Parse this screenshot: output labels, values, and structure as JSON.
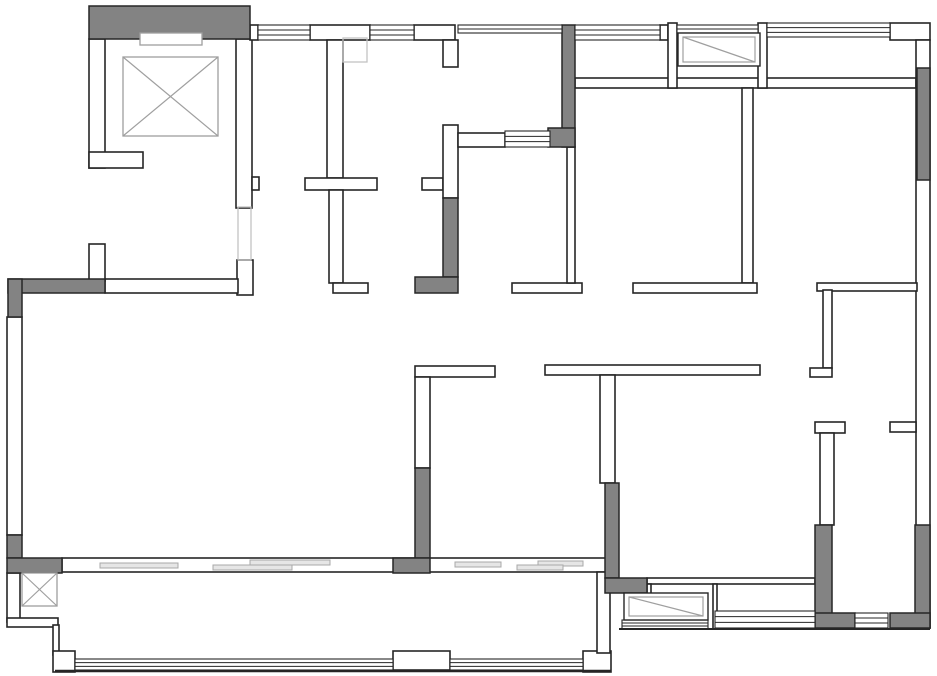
{
  "canvas": {
    "width": 937,
    "height": 676,
    "background": "#ffffff"
  },
  "palette": {
    "wall_stroke": "#262626",
    "wall_fill": "#ffffff",
    "column_fill": "#838383",
    "light_stroke": "#9f9f9f",
    "faint_stroke": "#c2c2c2",
    "panel_fill": "#e6e6e6",
    "panel_stroke": "#a8a8a8"
  },
  "shapes": [
    {
      "t": "wall",
      "n": "elevator-wall-left",
      "b": [
        89,
        39,
        16,
        129
      ]
    },
    {
      "t": "wall",
      "n": "elevator-wall-foot-left",
      "b": [
        89,
        152,
        54,
        16
      ]
    },
    {
      "t": "wall",
      "n": "elevator-wall-right",
      "b": [
        236,
        39,
        16,
        169
      ]
    },
    {
      "t": "wall",
      "n": "hall-wall-bump",
      "b": [
        252,
        177,
        7,
        13
      ]
    },
    {
      "t": "wall",
      "n": "hall-wall-lower",
      "b": [
        237,
        260,
        16,
        35
      ]
    },
    {
      "t": "wall",
      "n": "hall-wall-horizontal",
      "b": [
        105,
        279,
        133,
        14
      ]
    },
    {
      "t": "wall",
      "n": "wall-stub-left",
      "b": [
        89,
        244,
        16,
        37
      ]
    },
    {
      "t": "wall",
      "n": "exterior-wall-left",
      "b": [
        7,
        317,
        15,
        218
      ]
    },
    {
      "t": "wall",
      "n": "top-pier-a",
      "b": [
        250,
        25,
        8,
        15
      ]
    },
    {
      "t": "wall",
      "n": "top-pier-b",
      "b": [
        310,
        25,
        60,
        15
      ]
    },
    {
      "t": "wall",
      "n": "top-pier-c",
      "b": [
        414,
        25,
        41,
        15
      ]
    },
    {
      "t": "wall",
      "n": "top-pier-d",
      "b": [
        660,
        25,
        8,
        15
      ]
    },
    {
      "t": "wall",
      "n": "bath-stub-top",
      "b": [
        443,
        40,
        15,
        27
      ]
    },
    {
      "t": "wall",
      "n": "entry-wall-vertical-upper",
      "b": [
        327,
        40,
        16,
        138
      ]
    },
    {
      "t": "wall",
      "n": "entry-wall-cross",
      "b": [
        305,
        178,
        72,
        12
      ]
    },
    {
      "t": "wall",
      "n": "entry-wall-vertical-lower",
      "b": [
        329,
        190,
        14,
        93
      ]
    },
    {
      "t": "wall",
      "n": "entry-wall-foot",
      "b": [
        333,
        283,
        35,
        10
      ]
    },
    {
      "t": "wall",
      "n": "kitchen-stub",
      "b": [
        422,
        178,
        21,
        12
      ]
    },
    {
      "t": "wall",
      "n": "bath-wall-left",
      "b": [
        443,
        125,
        15,
        73
      ]
    },
    {
      "t": "wall",
      "n": "bath-wall-horizontal",
      "b": [
        458,
        133,
        47,
        14
      ]
    },
    {
      "t": "wall",
      "n": "hallway-wall-horizontal",
      "b": [
        512,
        283,
        70,
        10
      ]
    },
    {
      "t": "wall",
      "n": "bath-wall-thin-vertical",
      "b": [
        567,
        147,
        8,
        136
      ]
    },
    {
      "t": "wall",
      "n": "bedroom-top-wall",
      "b": [
        575,
        78,
        341,
        10
      ]
    },
    {
      "t": "wall",
      "n": "ac-cell-wall-left",
      "b": [
        668,
        23,
        9,
        65
      ]
    },
    {
      "t": "wall",
      "n": "ac-cell-wall-right",
      "b": [
        758,
        23,
        9,
        65
      ]
    },
    {
      "t": "wall",
      "n": "top-right-pier",
      "b": [
        890,
        23,
        40,
        17
      ]
    },
    {
      "t": "wall",
      "n": "exterior-wall-right",
      "b": [
        916,
        40,
        14,
        588
      ]
    },
    {
      "t": "wall",
      "n": "bedroom-divider-wall",
      "b": [
        742,
        88,
        11,
        195
      ]
    },
    {
      "t": "wall",
      "n": "bedroom-bottom-wall-left",
      "b": [
        633,
        283,
        124,
        10
      ]
    },
    {
      "t": "wall",
      "n": "bedroom-bottom-wall-right",
      "b": [
        817,
        283,
        100,
        8
      ]
    },
    {
      "t": "wall",
      "n": "closet-wall-vertical",
      "b": [
        823,
        290,
        9,
        78
      ]
    },
    {
      "t": "wall",
      "n": "closet-wall-foot",
      "b": [
        810,
        368,
        22,
        9
      ]
    },
    {
      "t": "wall",
      "n": "midroom-stub-left",
      "b": [
        415,
        366,
        80,
        11
      ]
    },
    {
      "t": "wall",
      "n": "midroom-wall-left",
      "b": [
        415,
        377,
        15,
        91
      ]
    },
    {
      "t": "wall",
      "n": "midroom-stub-right",
      "b": [
        545,
        365,
        215,
        10
      ]
    },
    {
      "t": "wall",
      "n": "midroom-wall-right",
      "b": [
        600,
        375,
        15,
        108
      ]
    },
    {
      "t": "wall",
      "n": "balcony-divider-band",
      "b": [
        62,
        558,
        545,
        14
      ]
    },
    {
      "t": "wall",
      "n": "br-balcony-bracket-left",
      "b": [
        815,
        422,
        30,
        11
      ]
    },
    {
      "t": "wall",
      "n": "br-balcony-bracket-right",
      "b": [
        890,
        422,
        26,
        10
      ]
    },
    {
      "t": "wall",
      "n": "br-balcony-wall-left",
      "b": [
        820,
        433,
        14,
        92
      ]
    },
    {
      "t": "wall",
      "n": "bl-balcony-wall-left",
      "b": [
        7,
        573,
        13,
        49
      ]
    },
    {
      "t": "wall",
      "n": "bl-balcony-step",
      "b": [
        7,
        618,
        51,
        9
      ]
    },
    {
      "t": "wall",
      "n": "bl-balcony-wall-thin",
      "b": [
        53,
        625,
        6,
        30
      ]
    },
    {
      "t": "wall",
      "n": "bl-balcony-corner",
      "b": [
        53,
        651,
        22,
        21
      ]
    },
    {
      "t": "wall",
      "n": "balcony-bottom-pier",
      "b": [
        393,
        651,
        57,
        19
      ]
    },
    {
      "t": "wall",
      "n": "balcony-corner-right",
      "b": [
        583,
        651,
        28,
        21
      ]
    },
    {
      "t": "wall",
      "n": "balcony-wall-right",
      "b": [
        597,
        572,
        13,
        81
      ]
    },
    {
      "t": "wall",
      "n": "dining-thin-wall",
      "b": [
        647,
        578,
        168,
        6
      ]
    },
    {
      "t": "wall",
      "n": "bay-thin-wall-left",
      "b": [
        647,
        584,
        4,
        45
      ]
    },
    {
      "t": "wall",
      "n": "bay-thin-wall-mid",
      "b": [
        713,
        584,
        4,
        45
      ]
    },
    {
      "t": "col",
      "n": "column-elevator-top",
      "b": [
        89,
        6,
        161,
        33
      ]
    },
    {
      "t": "col",
      "n": "column-top-middle",
      "b": [
        562,
        25,
        13,
        122
      ]
    },
    {
      "t": "col",
      "n": "column-bath-corner",
      "b": [
        548,
        128,
        27,
        19
      ]
    },
    {
      "t": "col",
      "n": "column-bath-left",
      "b": [
        443,
        198,
        15,
        79
      ]
    },
    {
      "t": "col",
      "n": "column-bath-foot",
      "b": [
        415,
        277,
        43,
        16
      ]
    },
    {
      "t": "col",
      "n": "column-left-horizontal",
      "b": [
        8,
        279,
        97,
        14
      ]
    },
    {
      "t": "col",
      "n": "column-left-vertical",
      "b": [
        8,
        279,
        14,
        38
      ]
    },
    {
      "t": "col",
      "n": "column-right-top",
      "b": [
        917,
        68,
        13,
        112
      ]
    },
    {
      "t": "col",
      "n": "column-mid-left",
      "b": [
        415,
        468,
        15,
        90
      ]
    },
    {
      "t": "col",
      "n": "column-mid-left-foot",
      "b": [
        393,
        558,
        37,
        15
      ]
    },
    {
      "t": "col",
      "n": "column-mid-right",
      "b": [
        605,
        483,
        14,
        95
      ]
    },
    {
      "t": "col",
      "n": "column-mid-right-foot",
      "b": [
        605,
        578,
        42,
        15
      ]
    },
    {
      "t": "col",
      "n": "column-bl-vertical",
      "b": [
        7,
        535,
        15,
        23
      ]
    },
    {
      "t": "col",
      "n": "column-bl-foot",
      "b": [
        7,
        558,
        55,
        15
      ]
    },
    {
      "t": "col",
      "n": "column-br-left",
      "b": [
        815,
        525,
        17,
        103
      ]
    },
    {
      "t": "col",
      "n": "column-br-right",
      "b": [
        915,
        525,
        15,
        103
      ]
    },
    {
      "t": "col",
      "n": "column-br-foot-left",
      "b": [
        815,
        613,
        40,
        15
      ]
    },
    {
      "t": "col",
      "n": "column-br-foot-right",
      "b": [
        890,
        613,
        40,
        15
      ]
    },
    {
      "t": "win",
      "n": "window-top-1",
      "b": [
        258,
        25,
        52,
        15
      ]
    },
    {
      "t": "win",
      "n": "window-top-2",
      "b": [
        370,
        25,
        44,
        15
      ]
    },
    {
      "t": "win",
      "n": "window-top-3",
      "b": [
        575,
        25,
        85,
        15
      ]
    },
    {
      "t": "win",
      "n": "window-top-4",
      "b": [
        767,
        23,
        123,
        14
      ]
    },
    {
      "t": "win",
      "n": "window-bathroom",
      "b": [
        505,
        131,
        45,
        16
      ]
    },
    {
      "t": "win",
      "n": "window-bay-right",
      "b": [
        715,
        611,
        100,
        17
      ]
    },
    {
      "t": "win",
      "n": "window-ac-bottom",
      "b": [
        622,
        620,
        86,
        9
      ]
    },
    {
      "t": "win",
      "n": "window-br-balcony",
      "b": [
        855,
        613,
        33,
        15
      ]
    },
    {
      "t": "win",
      "n": "window-balcony-left",
      "b": [
        75,
        659,
        318,
        11
      ]
    },
    {
      "t": "win",
      "n": "window-balcony-right",
      "b": [
        450,
        659,
        133,
        11
      ]
    },
    {
      "t": "glass",
      "n": "glass-bath-top",
      "b": [
        458,
        25,
        104,
        8
      ]
    },
    {
      "t": "glass",
      "n": "glass-ac-cell-top",
      "b": [
        677,
        25,
        81,
        8
      ]
    },
    {
      "t": "lightrect",
      "n": "elevator-counterweight",
      "b": [
        140,
        33,
        62,
        12
      ],
      "fill": "#ffffff",
      "tone": "light"
    },
    {
      "t": "xbox",
      "n": "elevator-car-symbol",
      "b": [
        123,
        57,
        95,
        79
      ]
    },
    {
      "t": "xbox",
      "n": "shaft-symbol",
      "b": [
        22,
        573,
        35,
        33
      ]
    },
    {
      "t": "lightrect",
      "n": "duct-square",
      "b": [
        343,
        38,
        24,
        24
      ],
      "fill": "none",
      "tone": "faint"
    },
    {
      "t": "lightrect",
      "n": "door-opening-hall",
      "b": [
        238,
        207,
        13,
        53
      ],
      "fill": "none",
      "tone": "faint"
    },
    {
      "t": "acbox",
      "n": "ac-platform-top",
      "b": [
        678,
        33,
        82,
        33
      ]
    },
    {
      "t": "acbox",
      "n": "ac-platform-bottom",
      "b": [
        624,
        593,
        84,
        27
      ]
    },
    {
      "t": "panel",
      "n": "sliding-panel-1",
      "b": [
        100,
        563,
        78,
        5
      ]
    },
    {
      "t": "panel",
      "n": "sliding-panel-2",
      "b": [
        250,
        560,
        80,
        5
      ]
    },
    {
      "t": "panel",
      "n": "sliding-panel-3",
      "b": [
        213,
        565,
        79,
        5
      ]
    },
    {
      "t": "panel",
      "n": "sliding-panel-4",
      "b": [
        455,
        562,
        46,
        5
      ]
    },
    {
      "t": "panel",
      "n": "sliding-panel-5",
      "b": [
        538,
        561,
        45,
        5
      ]
    },
    {
      "t": "panel",
      "n": "sliding-panel-6",
      "b": [
        517,
        565,
        46,
        5
      ]
    },
    {
      "t": "line",
      "n": "balcony-bottom-edge",
      "p": [
        55,
        671,
        611,
        671
      ],
      "lw": 2.4
    },
    {
      "t": "line",
      "n": "bay-bottom-edge",
      "p": [
        619,
        629,
        930,
        629
      ],
      "lw": 2
    }
  ]
}
